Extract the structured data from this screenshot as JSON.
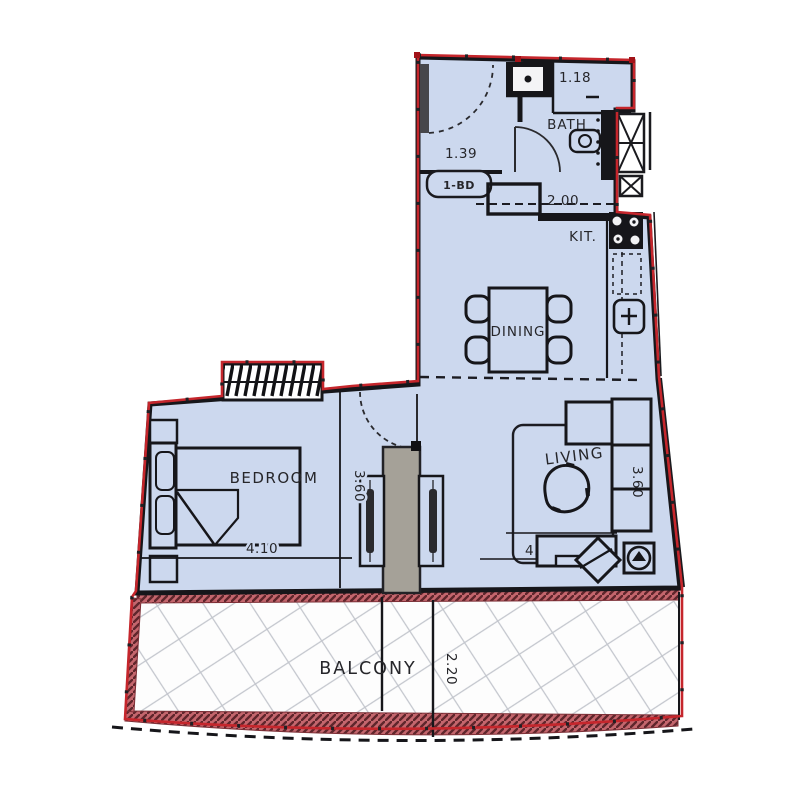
{
  "unit": {
    "type_badge": "1-BD"
  },
  "rooms": {
    "bath": {
      "label": "BATH"
    },
    "kitchen": {
      "label": "KIT."
    },
    "dining": {
      "label": "DINING"
    },
    "living": {
      "label": "LIVING"
    },
    "bedroom": {
      "label": "BEDROOM"
    },
    "balcony": {
      "label": "BALCONY"
    }
  },
  "dimensions": {
    "entry_width": "1.39",
    "shower_width": "1.18",
    "kitchen_run": "2.00",
    "corridor_depth": "3.60",
    "living_depth": "3.60",
    "bedroom_width": "4.10",
    "living_width": "4.10",
    "balcony_depth": "2.20"
  },
  "colors": {
    "floor": "#ccd8ee",
    "wall": "#16161a",
    "boundary_red": "#c5262c",
    "rail_maroon": "#c4666d",
    "rail_hatch_dark": "#5f262c",
    "column_gray": "#a5a198",
    "tile_grid": "#c3c6cd",
    "text": "#26262a"
  }
}
